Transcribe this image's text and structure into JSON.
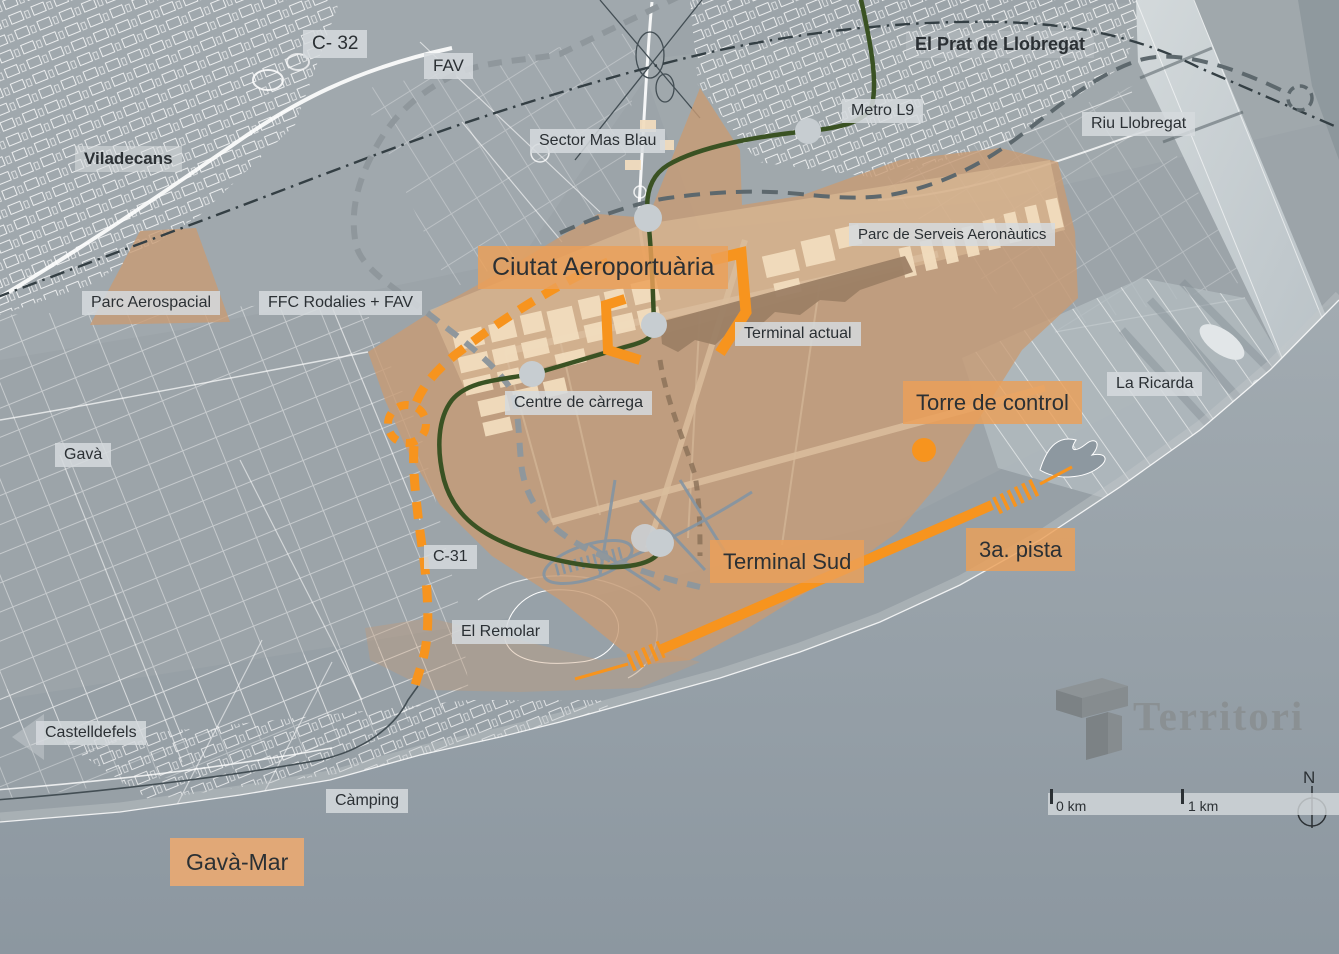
{
  "labels": {
    "c32": "C- 32",
    "fav": "FAV",
    "viladecans": "Viladecans",
    "el_prat": "El Prat de Llobregat",
    "metro_l9": "Metro L9",
    "riu_llobregat": "Riu Llobregat",
    "sector_mas_blau": "Sector Mas Blau",
    "parc_serveis": "Parc de Serveis Aeronàutics",
    "parc_aerospacial": "Parc Aerospacial",
    "ffc_rodalies": "FFC Rodalies + FAV",
    "ciutat": "Ciutat Aeroportuària",
    "terminal_actual": "Terminal actual",
    "centre_carrega": "Centre de càrrega",
    "torre_control": "Torre de control",
    "la_ricarda": "La Ricarda",
    "gava": "Gavà",
    "c31": "C-31",
    "el_remolar": "El Remolar",
    "terminal_sud": "Terminal Sud",
    "tercera_pista": "3a. pista",
    "castelldefels": "Castelldefels",
    "camping": "Càmping",
    "gava_mar": "Gavà-Mar"
  },
  "legend": {
    "scale_zero": "0 km",
    "scale_one": "1 km",
    "north": "N"
  },
  "logo": {
    "text": "Territori"
  },
  "colors": {
    "accent-orange": "#F7941E",
    "airport-tan": "#C89B74",
    "metro-green": "#3A5223",
    "building-cream": "#F2DDBE",
    "terminal-brown": "#9C8065",
    "steel-blue": "#8495A3",
    "land-gray": "#9CA4A9",
    "sea-gray": "#96A0A7",
    "ink": "#2B3034",
    "logo-gray": "#8A9093",
    "label-gray": "#D5DADD"
  }
}
